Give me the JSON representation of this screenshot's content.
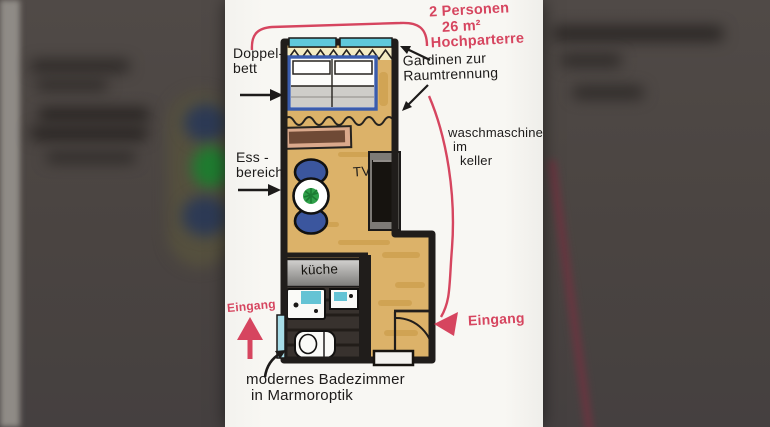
{
  "annotations": {
    "unit_info": [
      "2 Personen",
      "26 m²",
      "Hochparterre"
    ],
    "doppelbett": [
      "Doppel-",
      "bett"
    ],
    "gardinen": [
      "Gardinen zur",
      "Raumtrennung"
    ],
    "waschmaschine": [
      "waschmaschine",
      "im",
      "keller"
    ],
    "essbereich": [
      "Ess -",
      "bereich"
    ],
    "tv": "TV",
    "kueche": "küche",
    "eingang_left": "Eingang",
    "eingang_right": "Eingang",
    "badezimmer": [
      "modernes Badezimmer",
      "in Marmoroptik"
    ]
  },
  "colors": {
    "accent_red": "#d6455f",
    "ink": "#211e1c",
    "floor_wood": "#dcb269",
    "window_teal": "#5fc8da",
    "bed_frame_blue": "#3a5cad",
    "chair_navy": "#3b569e",
    "plant_green": "#2fa04a",
    "sideboard_brown": "#daa98c",
    "counter_gray": "#a9a8a6",
    "bathroom_dark": "#38322e"
  }
}
